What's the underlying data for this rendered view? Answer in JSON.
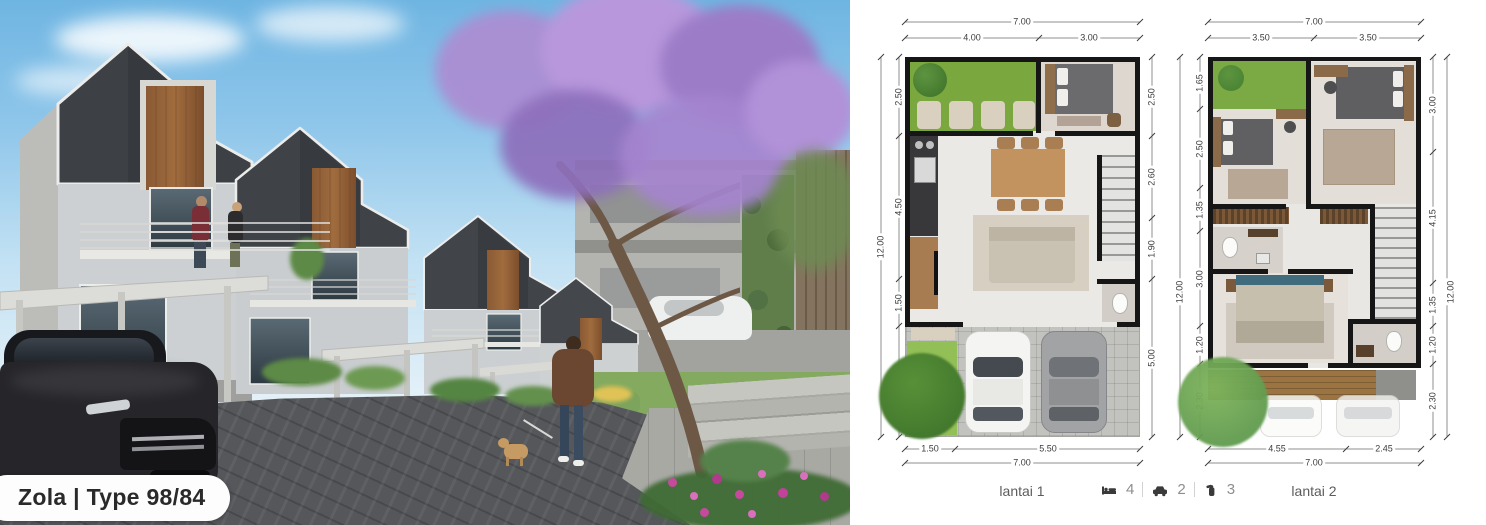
{
  "badge": {
    "label": "Zola | Type 98/84"
  },
  "stats": {
    "bedrooms": "4",
    "carports": "2",
    "bathrooms": "3"
  },
  "plans": {
    "lantai1": {
      "label": "lantai 1",
      "top_total": "7.00",
      "top_segments": [
        "4.00",
        "3.00"
      ],
      "left_total": "12.00",
      "left_segments": [
        "2.50",
        "4.50",
        "1.50"
      ],
      "right_total": "12.00",
      "right_segments": [
        "2.50",
        "2.60",
        "1.90",
        "5.00"
      ],
      "bottom_segments": [
        "1.50",
        "5.50"
      ],
      "bottom_total": "7.00"
    },
    "lantai2": {
      "label": "lantai 2",
      "top_total": "7.00",
      "top_segments": [
        "3.50",
        "3.50"
      ],
      "left_segments": [
        "1.65",
        "2.50",
        "1.35",
        "3.00",
        "1.20",
        "2.30"
      ],
      "right_total": "12.00",
      "right_segments": [
        "3.00",
        "4.15",
        "1.35",
        "1.20",
        "2.30"
      ],
      "bottom_segments": [
        "4.55",
        "2.45"
      ],
      "bottom_total": "7.00"
    }
  }
}
